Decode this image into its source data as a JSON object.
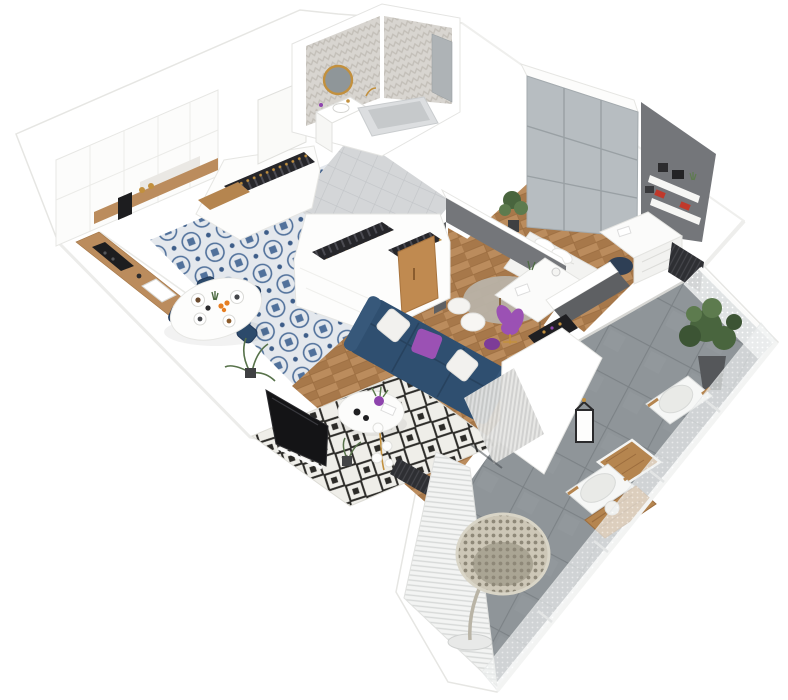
{
  "view": {
    "type": "3d-isometric-floor-plan",
    "subject": "apartment interior render with balcony",
    "background": "#ffffff"
  },
  "palette": {
    "wall_white": "#ffffff",
    "wall_edge": "#e4e4e1",
    "wall_shade": "#f0f0ee",
    "floor_wood": "#bb8c5d",
    "floor_wood_dark": "#a7784a",
    "floor_wood_line": "#9a6c3f",
    "tile_base": "#e4e8ed",
    "tile_blue": "#51719b",
    "tile_blue_dark": "#3d5d89",
    "hall_tile": "#d4d6d8",
    "hall_grout": "#c2c5c8",
    "bath_wall": "#d8d5d0",
    "bath_chevron": "#c3bfb8",
    "shower_tile": "#aeb3b6",
    "gray_wardrobe": "#b7bdc1",
    "gray_wardrobe_line": "#99a0a4",
    "accent_dark": "#5e6063",
    "accent_mid": "#74767a",
    "sofa_navy": "#2f4f70",
    "sofa_navy_dark": "#27425e",
    "pillow_purple": "#9b51b4",
    "pillow_white": "#f2f1ee",
    "rug_base": "#efeee9",
    "rug_dark": "#2c2b28",
    "chair_navy": "#2c4a6b",
    "gold": "#c2903e",
    "tv_black": "#141416",
    "balcony_tile": "#8f9599",
    "balcony_grout": "#7c8286",
    "outdoor_white": "#f6f7f6",
    "outdoor_cushion": "#e9eae7",
    "wood_outdoor": "#b5854f",
    "plant_green": "#49653e",
    "plant_green_light": "#5d7b4e",
    "curtain_light": "#e6e6e4",
    "curtain_dark": "#cfcfcd",
    "rattan": "#cdc7b7",
    "rattan_dark": "#8e8878",
    "door_oak": "#c08a50",
    "mirror_glass": "#8f9699",
    "clothes_dark": "#26262a",
    "radiator_dark": "#2e2f33",
    "book_red": "#c0392b",
    "fruit_orange": "#e67e22",
    "marble": "#eae8e4",
    "appliance_black": "#1d1d1f"
  },
  "rooms": [
    {
      "id": "kitchen-dining",
      "label": "Kitchen and Dining",
      "items": [
        "white-cabinets",
        "wood-countertop",
        "black-cooktop",
        "sink",
        "coffee-machine",
        "patterned-blue-tile-floor",
        "oval-dining-table",
        "navy-velvet-chairs",
        "tableware",
        "floor-plant"
      ]
    },
    {
      "id": "hallway",
      "label": "Hallway",
      "items": [
        "entrance-door",
        "open-wardrobes-with-hanging-clothes",
        "wooden-bench",
        "gray-tile-floor",
        "oak-closet-door"
      ]
    },
    {
      "id": "bathroom",
      "label": "Bathroom",
      "items": [
        "herringbone-tile-walls",
        "round-gold-mirror",
        "vanity-with-sink",
        "bathtub",
        "shower-corner"
      ]
    },
    {
      "id": "bedroom",
      "label": "Bedroom",
      "items": [
        "gray-paneled-wardrobe",
        "bed-with-white-bedding",
        "white-desk",
        "navy-desk-chair",
        "wall-shelves-with-books",
        "potted-plant",
        "window-radiator"
      ]
    },
    {
      "id": "office",
      "label": "Second Bedroom / Office",
      "items": [
        "dark-gray-walls",
        "white-desk",
        "purple-chair",
        "daybed-pillows",
        "round-rug",
        "bottle-rack"
      ]
    },
    {
      "id": "living-room",
      "label": "Living Room",
      "items": [
        "navy-sofa",
        "white-and-purple-pillows",
        "diamond-pattern-rug",
        "round-coffee-table",
        "tv-leaning-on-wall",
        "globe-floor-lamp",
        "curtains",
        "herringbone-wood-floor",
        "radiator"
      ]
    },
    {
      "id": "balcony",
      "label": "Balcony",
      "items": [
        "concrete-tile-floor",
        "white-mesh-railing",
        "louvered-privacy-screen",
        "hanging-egg-chair",
        "outdoor-armchairs",
        "wooden-coffee-table",
        "slatted-lounger",
        "black-lantern",
        "large-potted-plant"
      ]
    }
  ]
}
